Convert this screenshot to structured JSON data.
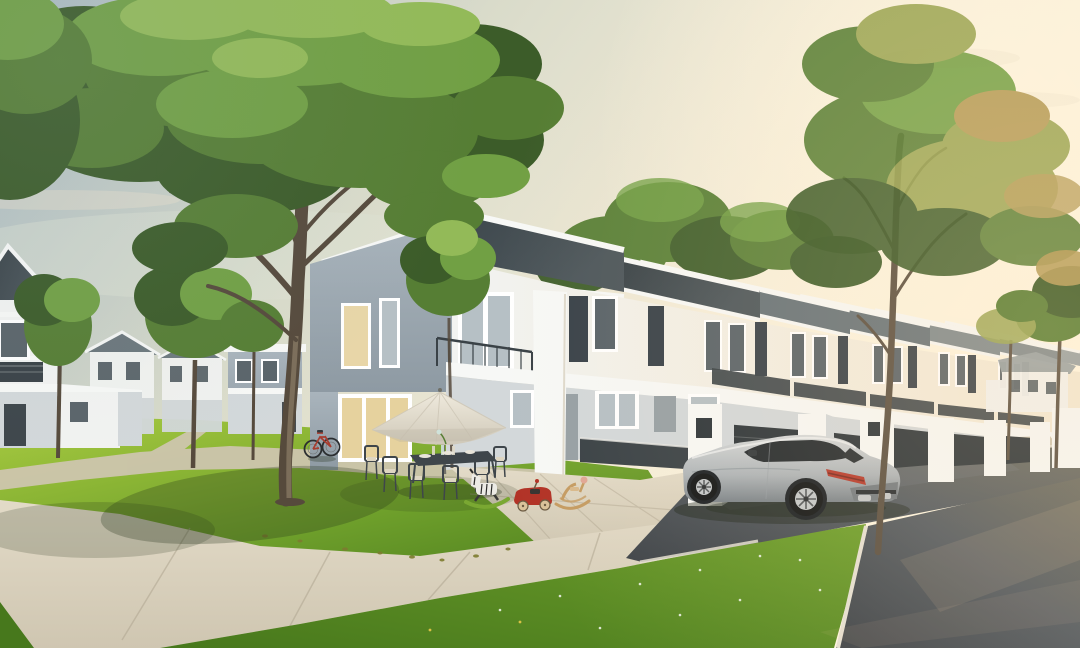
{
  "scene": {
    "title": "Residential development exterior rendering",
    "type": "3d-architectural-rendering",
    "time_of_day": "golden hour",
    "description": "Photorealistic rendering of a modern housing estate at golden hour: a row of white two-storey terrace houses with dark pitched roofs and white fascias recedes to the right, a silver coupe-SUV is parked on the asphalt driveway by white gate pillars, and the landscaped foreground holds a bright lawn with a white patio umbrella, an outdoor dining set, a red bicycle leaning on a large tree, children's toys, curved concrete walkways and an asphalt street, with detached houses, garden paths and backlit trees under a hazy warm sky.",
    "objects": [
      "hazy golden-hour sky with soft clouds",
      "sun glow",
      "row of two-storey terraced houses",
      "detached two-storey houses",
      "background bungalow",
      "large foreground shade tree",
      "tall backlit street tree",
      "background garden trees",
      "front lawn",
      "curved concrete walkway",
      "winding garden path",
      "asphalt street with white kerbs",
      "driveway aprons",
      "white gate pillars with dark metal gates",
      "silver coupe SUV",
      "white patio umbrella",
      "outdoor dining table and chairs",
      "red bicycle",
      "zebra rocking toy",
      "red toy pedal car",
      "wooden rocking toy"
    ]
  },
  "palette": {
    "sky_top": "#a8b9c0",
    "sky_mid": "#d9dbca",
    "sky_warm": "#f4ecd8",
    "sun_glow": "#fff7e2",
    "cloud": "#ece2cc",
    "haze": "#dfe3d4",
    "canopy_dark": "#3c5c29",
    "canopy_mid": "#567e34",
    "canopy_light": "#71a044",
    "canopy_highlight": "#93ba58",
    "canopy_backlit": "#9aa654",
    "canopy_warm": "#b39a55",
    "trunk_dark": "#564a3c",
    "trunk_light": "#8d7d67",
    "roof_dark": "#333c41",
    "roof_sheen": "#4e585d",
    "roof_mid": "#68747a",
    "roof_far": "#7f8a8e",
    "roof_pale": "#97a1a4",
    "fascia": "#f7f8f6",
    "wall_white": "#f2f3f1",
    "wall_warm": "#f3e9d4",
    "wall_shade": "#d3d8da",
    "wall_blue": "#a9b4bc",
    "wall_blue_dark": "#8e9aa3",
    "wall_grey": "#97a0a5",
    "glass_cool": "#b6c0c5",
    "glass_dark": "#5a646a",
    "glass_warm": "#e6d29e",
    "frame": "#ffffff",
    "louvre": "#39424a",
    "rail": "#3a4247",
    "gate": "#2e363b",
    "grass_light": "#a4c83d",
    "grass_mid": "#6e9f2b",
    "grass_dark": "#47781c",
    "grass_shadow": "#2f5716",
    "walk_light": "#e3dbc8",
    "walk_mid": "#cfc6b1",
    "walk_dark": "#b3a994",
    "road": "#3f4449",
    "road_mid": "#555c62",
    "road_warm": "#6e6e63",
    "curb": "#e5e0d3",
    "car_body": "#d6d9da",
    "car_mid": "#aeb4b8",
    "car_dark": "#7c848a",
    "car_glass": "#262c30",
    "tire": "#141718",
    "rim": "#c4c8ca",
    "tail_red": "#b63b2e",
    "tail_dark": "#7c2b22",
    "umbrella": "#efeadd",
    "umbrella_shade": "#cfc8b8",
    "furn": "#3f464b",
    "cushion": "#ded6c2",
    "toy_red": "#b23327",
    "toy_green": "#7aa832",
    "toy_wood": "#c59c63",
    "toy_white": "#ecebe5",
    "bike_red": "#a73c2f",
    "shadow": "#24321a",
    "warm_overlay": "#ffd9a6",
    "cool_overlay": "#9db0bd"
  }
}
